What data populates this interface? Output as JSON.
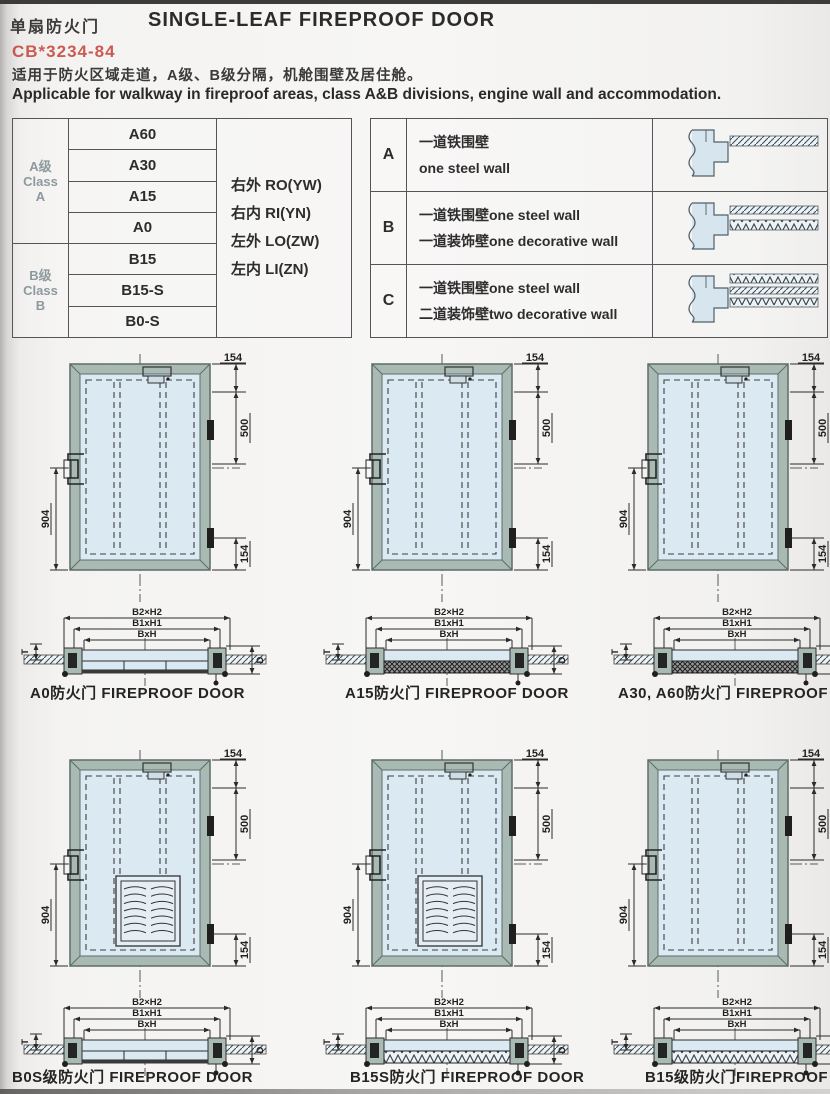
{
  "page": {
    "title_cn": "单扇防火门",
    "title_en": "SINGLE-LEAF FIREPROOF DOOR",
    "standard_code": "CB*3234-84",
    "description_cn": "适用于防火区域走道，A级、B级分隔，机舱围壁及居住舱。",
    "description_en": "Applicable for walkway in fireproof areas, class A&B divisions, engine wall and accommodation."
  },
  "class_table": {
    "groups": [
      {
        "label_lines": [
          "A级",
          "Class",
          "A"
        ],
        "models": [
          "A60",
          "A30",
          "A15",
          "A0"
        ]
      },
      {
        "label_lines": [
          "B级",
          "Class",
          "B"
        ],
        "models": [
          "B15",
          "B15-S",
          "B0-S"
        ]
      }
    ],
    "orientations": [
      "右外 RO(YW)",
      "右内 RI(YN)",
      "左外 LO(ZW)",
      "左内 LI(ZN)"
    ]
  },
  "wall_table": {
    "rows": [
      {
        "key": "A",
        "desc_lines": [
          "一道铁围壁",
          "one steel wall"
        ],
        "diagram": "one-steel-wall-section"
      },
      {
        "key": "B",
        "desc_lines": [
          "一道铁围壁one steel wall",
          "一道装饰壁one decorative wall"
        ],
        "diagram": "steel-wall-plus-one-decorative-wall-section"
      },
      {
        "key": "C",
        "desc_lines": [
          "一道铁围壁one steel wall",
          "二道装饰壁two decorative wall"
        ],
        "diagram": "steel-wall-plus-two-decorative-walls-section"
      }
    ]
  },
  "drawings": {
    "elevation_dims": {
      "top_right": "154",
      "right": "500",
      "left": "904",
      "bottom_right": "154"
    },
    "section_dims": {
      "outer": "B2×H2",
      "middle": "B1xH1",
      "inner": "BxH",
      "depth": "D",
      "thickness": "T"
    },
    "cells": [
      {
        "caption": "A0防火门 FIREPROOF DOOR",
        "louver": false,
        "section_fill": "plain"
      },
      {
        "caption": "A15防火门 FIREPROOF DOOR",
        "louver": false,
        "section_fill": "hatch"
      },
      {
        "caption": "A30, A60防火门 FIREPROOF DO",
        "louver": false,
        "section_fill": "hatch"
      },
      {
        "caption": "B0S级防火门 FIREPROOF DOOR",
        "louver": true,
        "section_fill": "plain"
      },
      {
        "caption": "B15S防火门 FIREPROOF DOOR",
        "louver": true,
        "section_fill": "zigzag"
      },
      {
        "caption": "B15级防火门FIREPROOF DOO",
        "louver": false,
        "section_fill": "zigzag"
      }
    ]
  },
  "colors": {
    "accent_red": "#c4473e",
    "frame_gray_green": "#a9b9b3",
    "panel_blue": "#dbe9f2",
    "line_dark": "#2b2b2b"
  }
}
